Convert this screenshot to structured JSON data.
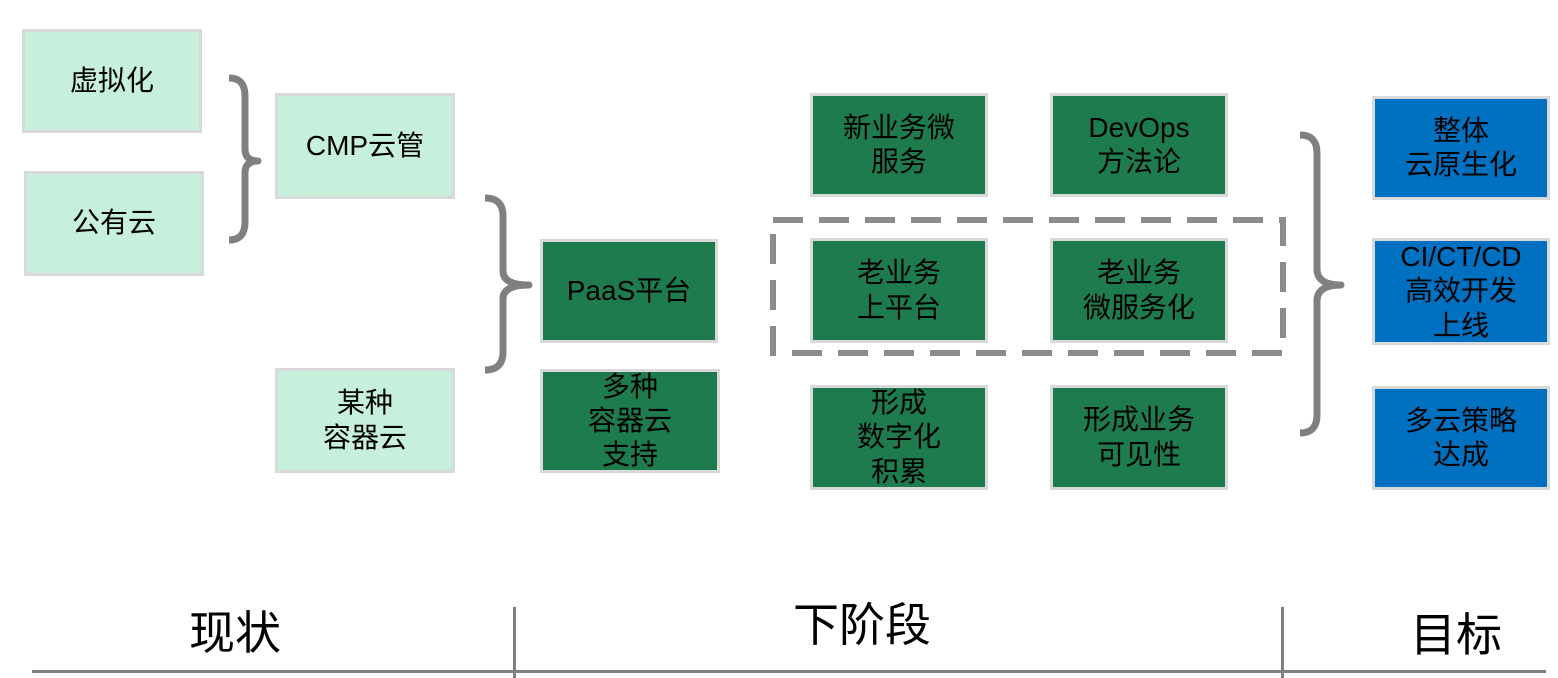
{
  "stage_labels": {
    "current": "现状",
    "next": "下阶段",
    "goal": "目标"
  },
  "boxes": {
    "virtualization": {
      "text": "虚拟化"
    },
    "public_cloud": {
      "text": "公有云"
    },
    "cmp_cloud_mgmt": {
      "text": "CMP云管"
    },
    "some_container_cloud": {
      "text": "某种\n容器云"
    },
    "paas_platform": {
      "text": "PaaS平台"
    },
    "multi_container_support": {
      "text": "多种\n容器云\n支持"
    },
    "new_biz_microservices": {
      "text": "新业务微\n服务"
    },
    "devops_methodology": {
      "text": "DevOps\n方法论"
    },
    "legacy_to_platform": {
      "text": "老业务\n上平台"
    },
    "legacy_microservitization": {
      "text": "老业务\n微服务化"
    },
    "digital_accumulation": {
      "text": "形成\n数字化\n积累"
    },
    "business_visibility": {
      "text": "形成业务\n可见性"
    },
    "overall_cloud_native": {
      "text": "整体\n云原生化"
    },
    "ci_ct_cd_delivery": {
      "text": "CI/CT/CD\n高效开发\n上线"
    },
    "multicloud_strategy": {
      "text": "多云策略\n达成"
    }
  },
  "colors": {
    "current_state_fill": "#C6F0DB",
    "next_stage_fill": "#1E7B4E",
    "goal_fill": "#0070C0",
    "box_border": "#D9D9D9",
    "connector_gray": "#808080",
    "dashed_outline_gray": "#8C8C8C"
  }
}
